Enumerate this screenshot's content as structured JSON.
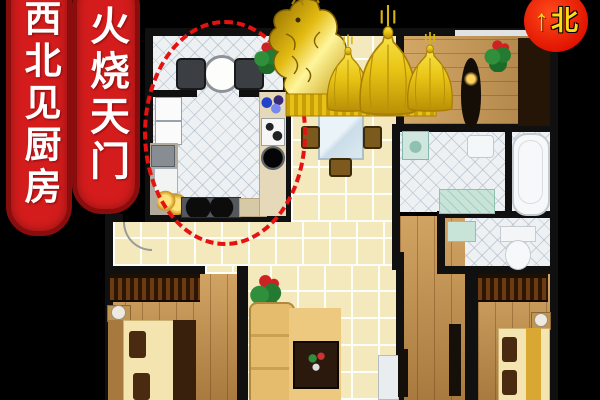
{
  "banners": [
    {
      "text": "西北见厨房"
    },
    {
      "text": "火烧天门"
    }
  ],
  "compass": {
    "arrow": "↑",
    "label": "北"
  },
  "colors": {
    "background": "#000000",
    "banner_red": "#d41c1c",
    "banner_border_red": "#8a0d0d",
    "banner_text": "#ffffff",
    "compass_red": "#e81600",
    "compass_yellow": "#ffd913",
    "highlight_ellipse_red": "#e51212",
    "statue_gold": "#f0cd16",
    "wall_black": "#101010",
    "kitchen_tile_white": "#eef1f3",
    "hall_tile_cream": "#f3e9bd",
    "wood_floor": "#c2914f"
  }
}
